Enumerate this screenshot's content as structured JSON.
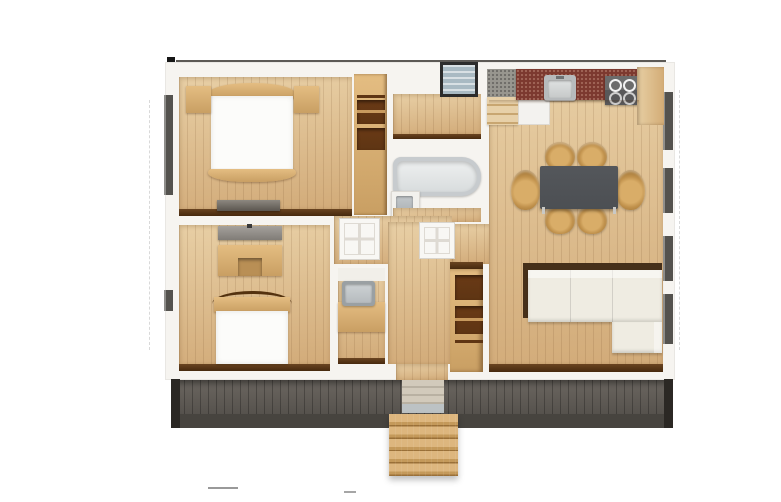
{
  "scene": {
    "type": "apartment-floor-plan",
    "view": "top-down-3d-render",
    "background": "#ffffff",
    "no_visible_text": true
  },
  "palette": {
    "building-wall": "#f6f4f0",
    "floor-hi": "#e8cfa5",
    "floor-lo": "#d2ab79",
    "trim-hi": "#6a4420",
    "trim-lo": "#47290e",
    "wood-hi": "#e4bd82",
    "wood-lo": "#c99f63",
    "wood-int": "#5e3513",
    "deck-hi": "#6b6660",
    "deck-lo": "#56524d",
    "deck-fascia": "#47443f",
    "deck-post": "#2b2824",
    "step-hi": "#ddb67e",
    "step-lo": "#c4995a",
    "linen": "#fcfcfa",
    "gray-dresser": "#9b9792",
    "counter-red": "#7c392f",
    "counter-gray": "#98968f",
    "appliance": "#6c6c6c",
    "steel": "#b7babc",
    "table": "#4c4f53",
    "chair-hi": "#d9ad68",
    "chair-lo": "#a87c3c",
    "sofa": "#efece2",
    "sofa-trim": "#46301a",
    "tub-rim": "#c7cbce",
    "tub-in": "#eef0f0",
    "fixture": "#aab0b3",
    "glass": "#a9bac3",
    "win-dark": "#54524e",
    "door": "#f8f7f4",
    "marker": "#161616"
  },
  "rooms": [
    {
      "name": "bedroom-top-left",
      "furniture": [
        "double-bed",
        "nightstand-left",
        "nightstand-right",
        "wardrobe-shelves",
        "low-dresser"
      ]
    },
    {
      "name": "bedroom-bottom-left",
      "furniture": [
        "bed",
        "desk",
        "gray-dresser"
      ]
    },
    {
      "name": "bathroom",
      "furniture": [
        "bathtub",
        "sink-vanity"
      ]
    },
    {
      "name": "utility-room",
      "furniture": [
        "wash-sink",
        "wood-counter"
      ]
    },
    {
      "name": "hallway",
      "furniture": [
        "open-door-1",
        "open-door-2",
        "top-window"
      ]
    },
    {
      "name": "kitchen",
      "furniture": [
        "gray-corner-counter",
        "red-stone-counter",
        "kitchen-sink",
        "cooktop",
        "wood-end-counter",
        "white-appliance"
      ]
    },
    {
      "name": "dining-area",
      "furniture": [
        "dark-dining-table",
        "wood-chairs"
      ]
    },
    {
      "name": "living-area",
      "furniture": [
        "l-shaped-cream-sofa",
        "open-shelf-closet"
      ]
    },
    {
      "name": "deck",
      "furniture": [
        "entry-ramp",
        "exterior-wood-steps"
      ]
    }
  ],
  "counts": {
    "dining_chairs": 6,
    "cooktop_burners": 4,
    "right_wall_windows": 4,
    "exterior_step_treads": 5
  }
}
